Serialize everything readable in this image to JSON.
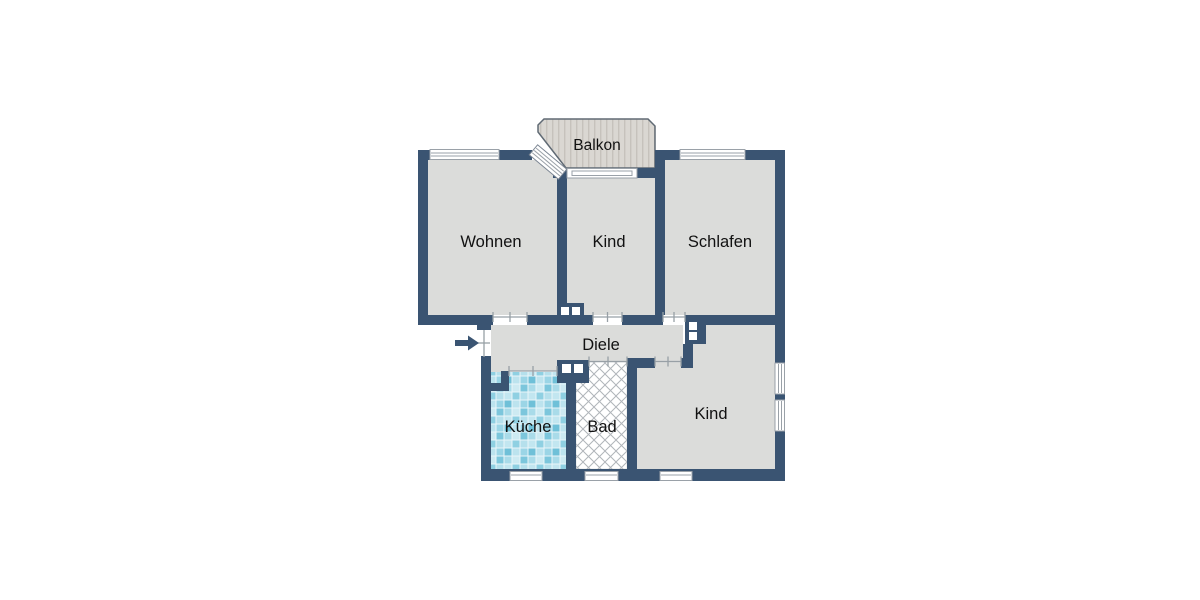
{
  "plan_title": "Wohnung Grundriss",
  "rooms": {
    "balkon": {
      "label": "Balkon"
    },
    "wohnen": {
      "label": "Wohnen"
    },
    "kind_oben": {
      "label": "Kind"
    },
    "schlafen": {
      "label": "Schlafen"
    },
    "diele": {
      "label": "Diele"
    },
    "kueche": {
      "label": "Küche"
    },
    "bad": {
      "label": "Bad"
    },
    "kind_unten": {
      "label": "Kind"
    }
  },
  "colors": {
    "wall": "#3a5472",
    "room_fill": "#dbdcda",
    "balcony_fill": "#dad7d2",
    "balcony_stripe": "#c6c2bc",
    "tile_blue": "#8fd0e2",
    "lattice_line": "#b0b5ba",
    "door_line": "#98a0a6",
    "background": "#ffffff",
    "label_text": "#111111"
  },
  "textures": {
    "kueche_floor": "blue-mosaic-tiles",
    "bad_floor": "diagonal-cross-hatch",
    "balkon_floor": "vertical-decking-stripes"
  },
  "icons": {
    "entrance_arrow": "arrow-right-icon"
  }
}
